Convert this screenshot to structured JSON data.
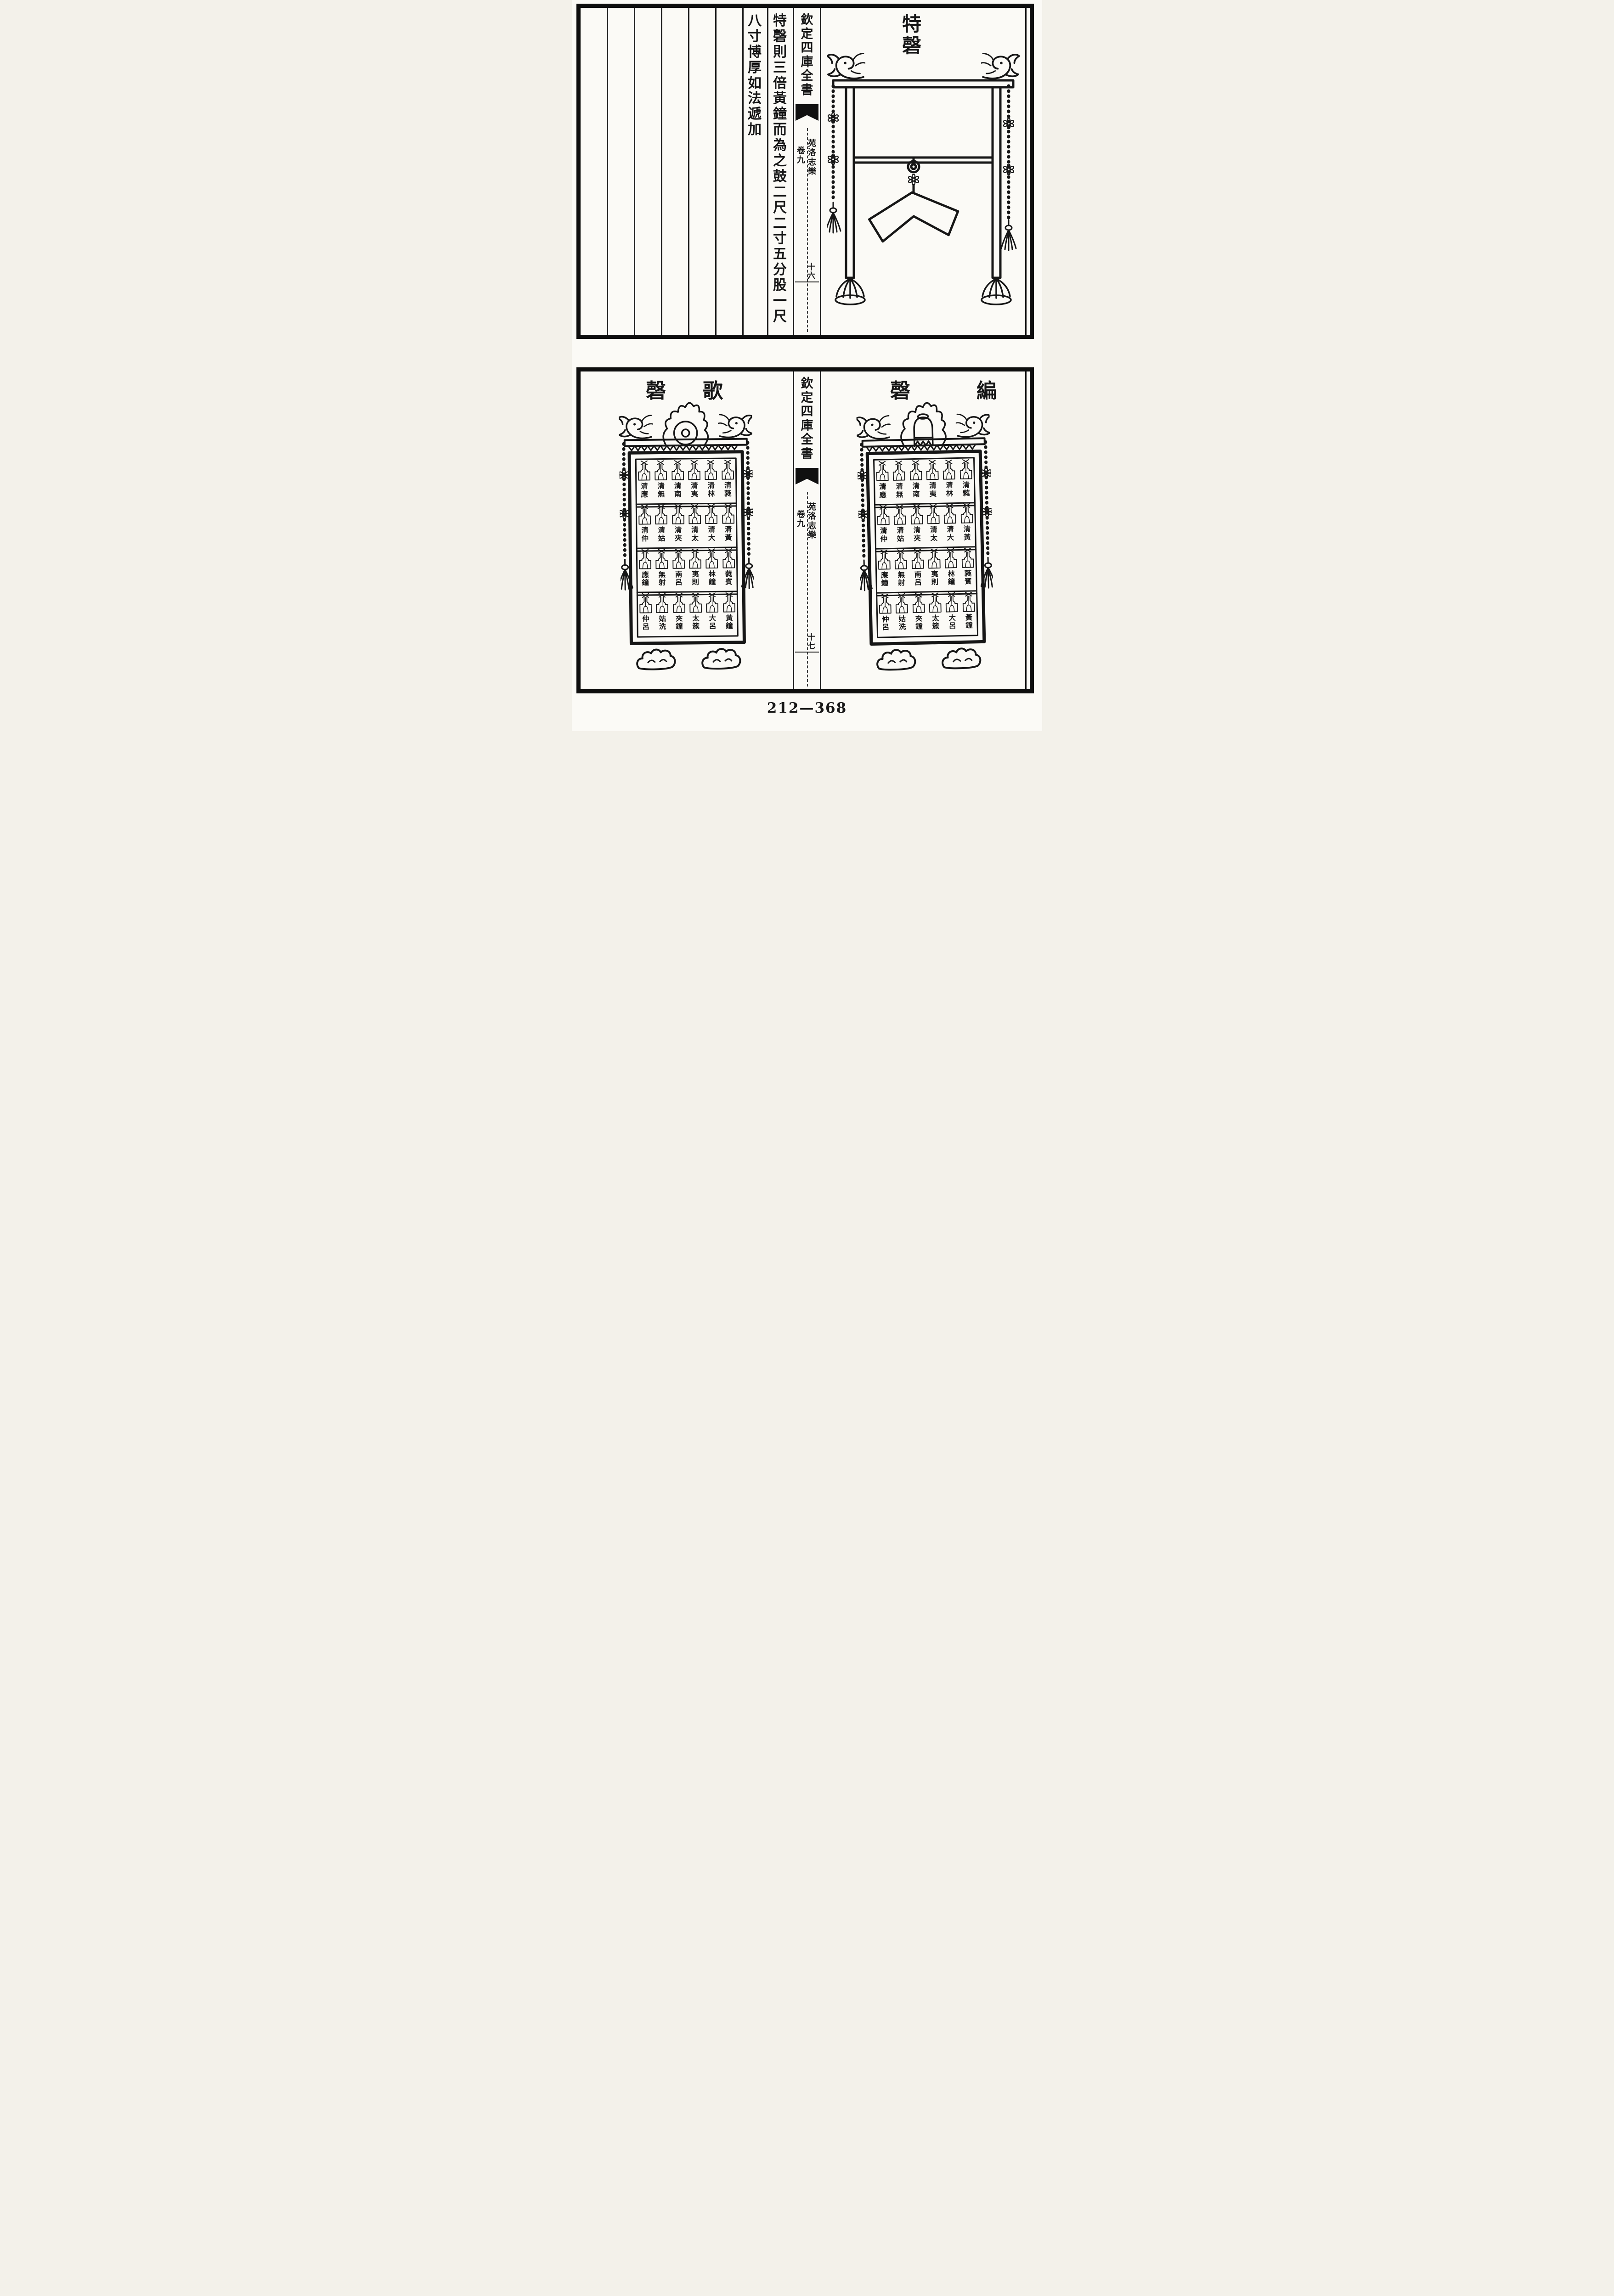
{
  "colors": {
    "ink": "#161616",
    "paper": "#fbfaf6"
  },
  "footer": {
    "catalog_number": "212—368"
  },
  "top_page": {
    "spine": {
      "series_title": "欽定四庫全書",
      "book_title": "苑洛志樂",
      "chapter_label": "卷九",
      "folio": "十六"
    },
    "illustration_title": "特磬",
    "text_columns": [
      "特磬則三倍黃鐘而為之鼓二尺二寸五分股一尺",
      "八寸博厚如法遞加"
    ]
  },
  "bottom_page": {
    "spine": {
      "series_title": "欽定四庫全書",
      "book_title": "苑洛志樂",
      "chapter_label": "卷九",
      "folio": "十七"
    },
    "left_rack_title": "歌磬",
    "right_rack_title": "編磬",
    "chime_labels": [
      [
        "清應",
        "清無",
        "清南",
        "清夷",
        "清林",
        "清蕤"
      ],
      [
        "清仲",
        "清姑",
        "清夾",
        "清太",
        "清大",
        "清黃"
      ],
      [
        "應鐘",
        "無射",
        "南呂",
        "夷則",
        "林鐘",
        "蕤賓"
      ],
      [
        "仲呂",
        "姑洗",
        "夾鐘",
        "太簇",
        "大呂",
        "黃鐘"
      ]
    ]
  }
}
